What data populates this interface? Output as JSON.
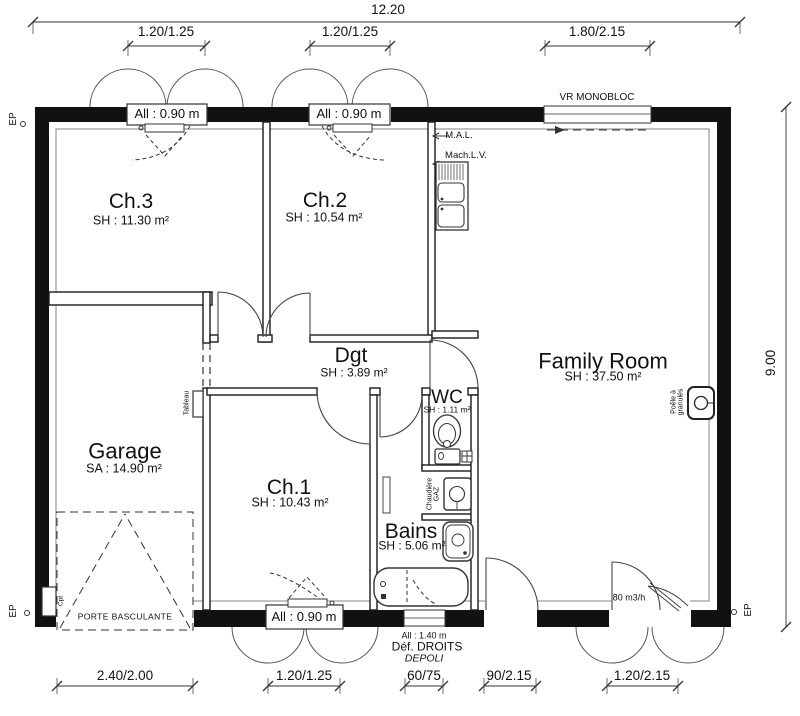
{
  "dims": {
    "top_overall": "12.20",
    "top_w1": "1.20/1.25",
    "top_w2": "1.20/1.25",
    "top_w3": "1.80/2.15",
    "right_overall": "9.00",
    "bot_garage": "2.40/2.00",
    "bot_ch1": "1.20/1.25",
    "bot_bains": "60/75",
    "bot_entry": "90/2.15",
    "bot_french": "1.20/2.15"
  },
  "rooms": {
    "ch3": {
      "name": "Ch.3",
      "area": "SH : 11.30 m²"
    },
    "ch2": {
      "name": "Ch.2",
      "area": "SH : 10.54 m²"
    },
    "family": {
      "name": "Family Room",
      "area": "SH : 37.50 m²"
    },
    "dgt": {
      "name": "Dgt",
      "area": "SH : 3.89 m²"
    },
    "wc": {
      "name": "WC",
      "area": "SH : 1.11 m²"
    },
    "garage": {
      "name": "Garage",
      "area": "SA : 14.90 m²"
    },
    "ch1": {
      "name": "Ch.1",
      "area": "SH : 10.43 m²"
    },
    "bains": {
      "name": "Bains",
      "area": "SH : 5.06 m²"
    }
  },
  "windows": {
    "w090": "All : 0.90 m",
    "vr": "VR MONOBLOC",
    "w140": "All : 1.40 m",
    "def_droits": "Déf. DROITS",
    "depoli": "DEPOLI"
  },
  "fixtures": {
    "mal": "M.A.L.",
    "machlv": "Mach.L.V.",
    "tableau": "Tableau",
    "chaudiere_l1": "Chaudière",
    "chaudiere_l2": "GAZ",
    "poele_l1": "Poêle à",
    "poele_l2": "granulés",
    "cpt": "Cpt",
    "vent": "80 m3/h",
    "porte_basculante": "PORTE BASCULANTE"
  },
  "marks": {
    "ep": "EP"
  }
}
